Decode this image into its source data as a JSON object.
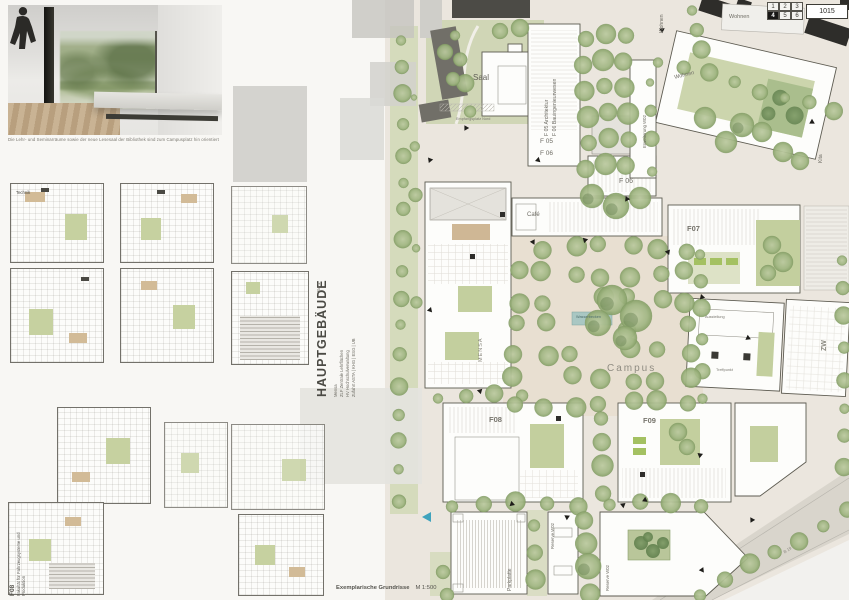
{
  "board": {
    "legend": {
      "cells": [
        "1",
        "2",
        "3",
        "4",
        "5",
        "6"
      ],
      "active": "4",
      "entry": "1015"
    },
    "render_caption": "Die Lehr- und Seminarräume sowie der neue Lesesaal der Bibliothek sind zum Campusplatz hin orientiert",
    "bottom_caption": "Exemplarische Grundrisse",
    "bottom_scale": "M 1:500"
  },
  "hauptgebaeude": {
    "title": "HAUPTGEBÄUDE",
    "phase": "BA 1",
    "lines": [
      "Mensa",
      "ZLF Zentrale Lehrflächen",
      "HV Hochschulverwaltung",
      "Zufahrt ASTA | KHG | ESG | UB"
    ]
  },
  "f08_annotation": {
    "code": "F08",
    "name": "Fakultät für Fahrzeugsysteme und Produktion"
  },
  "plans": {
    "technik": "Technik"
  },
  "site": {
    "labels": {
      "saal": "Saal",
      "f05_architektur": "F 05 Architektur",
      "f06_bauingenieurwesen": "F 06 Bauingenieurwesen",
      "f05": "F 05",
      "f06": "F 06",
      "f06_block": "F 06",
      "cafe": "Café",
      "f07": "F07",
      "mensa": "MENSA",
      "campus": "Campus",
      "zw": "ZW",
      "ausstellung": "Ausstellung",
      "treffpunkt": "Treffpunkt",
      "wasserbecken": "Wasserbecken",
      "empfangsplatz": "Empfangsplatz Nord",
      "f08": "F08",
      "f09": "F09",
      "parkplatte": "Parkplatte",
      "reserve_w02_a": "Reserve W02",
      "reserve_w02_b": "Reserve W02",
      "erweiterung_w02": "Erweiterung W02",
      "wohnen_street": "Wohnen",
      "wohnen_top": "Wohnen",
      "wohnen_block": "Wohnen",
      "kita": "Kita",
      "b19": "B 19"
    }
  }
}
